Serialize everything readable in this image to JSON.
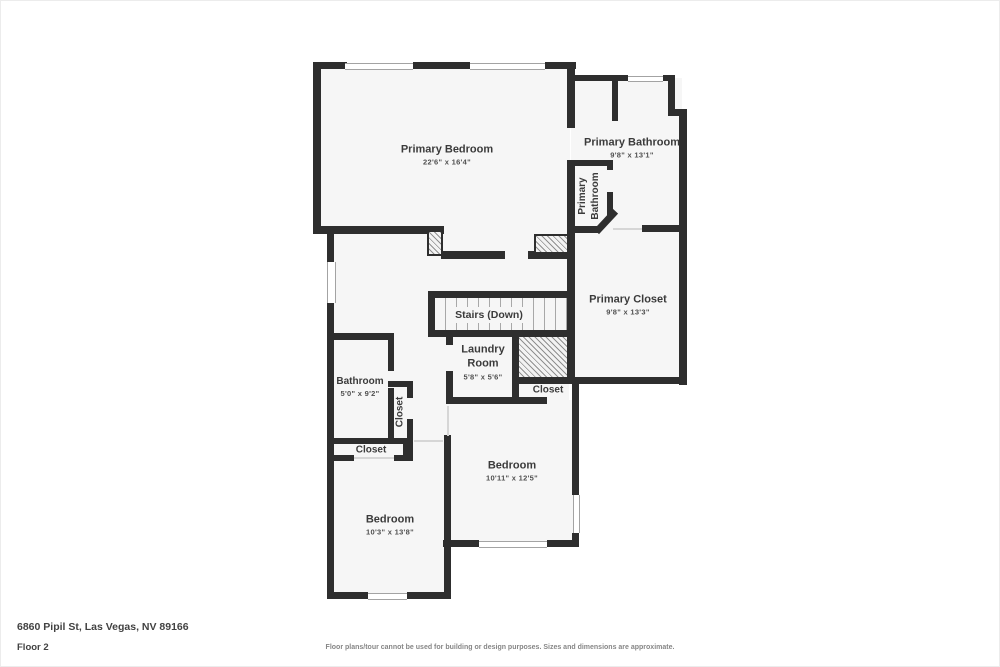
{
  "plan": {
    "colors": {
      "wall": "#2e2e2e",
      "floor_fill": "#f6f6f6",
      "text": "#3b3b3b"
    },
    "rooms": {
      "primary_bedroom": {
        "label": "Primary Bedroom",
        "dims": "22'6\" x 16'4\""
      },
      "primary_bathroom": {
        "label": "Primary Bathroom",
        "dims": "9'8\" x 13'1\""
      },
      "primary_bathroom_wc": {
        "label": "Primary Bathroom"
      },
      "primary_closet": {
        "label": "Primary Closet",
        "dims": "9'8\" x 13'3\""
      },
      "stairs": {
        "label": "Stairs (Down)"
      },
      "laundry": {
        "label": "Laundry Room",
        "dims": "5'8\" x 5'6\""
      },
      "closet_hall": {
        "label": "Closet"
      },
      "bathroom": {
        "label": "Bathroom",
        "dims": "5'0\" x 9'2\""
      },
      "closet_vertical": {
        "label": "Closet"
      },
      "closet_lower": {
        "label": "Closet"
      },
      "bedroom_right": {
        "label": "Bedroom",
        "dims": "10'11\" x 12'5\""
      },
      "bedroom_left": {
        "label": "Bedroom",
        "dims": "10'3\" x 13'8\""
      }
    }
  },
  "footer": {
    "address": "6860 Pipil St, Las Vegas, NV 89166",
    "floor": "Floor 2",
    "disclaimer": "Floor plans/tour cannot be used for building or design purposes. Sizes and dimensions are approximate."
  }
}
